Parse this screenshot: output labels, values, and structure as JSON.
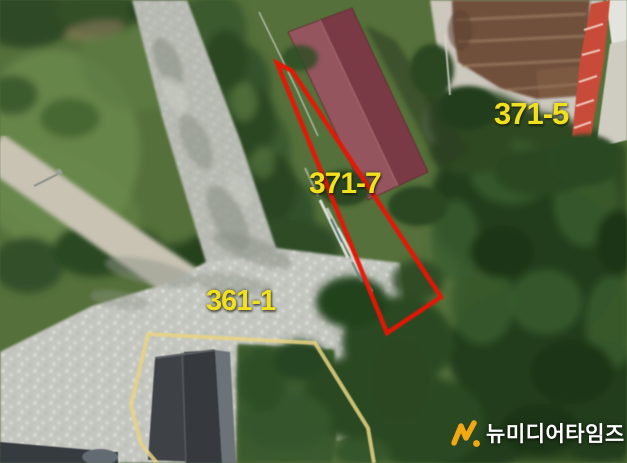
{
  "page": {
    "type": "aerial-cadastral-photo",
    "width_px": 627,
    "height_px": 463
  },
  "parcels": {
    "labels": [
      {
        "text": "371-5"
      },
      {
        "text": "371-7"
      },
      {
        "text": "361-1"
      }
    ],
    "highlighted_parcel": "371-7"
  },
  "watermark": {
    "logo_icon": "newmedia-n-icon",
    "logo_glyph": "N.",
    "text": "뉴미디어타임즈"
  },
  "colors": {
    "parcel_label": "#f0e01e",
    "parcel_outline": "#e91505",
    "boundary_line": "#e7d382",
    "logo_orange": "#f3a713",
    "watermark_text": "#ffffff"
  }
}
